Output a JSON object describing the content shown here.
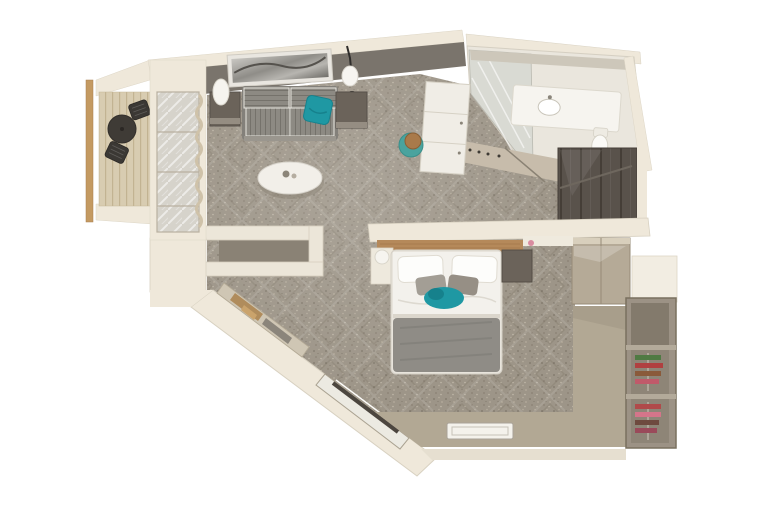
{
  "scene": {
    "title": "3D top-down floor plan render of a hotel suite with balcony",
    "style": "photorealistic axonometric render, no visible text",
    "background": "#ffffff"
  },
  "colors": {
    "wall_top": "#efe8da",
    "wall_face": "#7a746c",
    "wall_edge": "#d8d1c1",
    "carpet_base": "#9d9588",
    "deck_wood": "#d8ccb1",
    "railing": "#c49a62",
    "glass": "#d6d3cb",
    "sofa_fabric": "#8d8a83",
    "accent_teal": "#1f98a3",
    "side_table": "#6b635a",
    "coffee_table": "#f2efe9",
    "cabinet_white": "#f0ede6",
    "stool_teal": "#4aa39e",
    "stool_wood": "#a97a4a",
    "bed_duvet": "#f3f1ec",
    "bed_blanket": "#8f8c86",
    "pillow_gray": "#a39e95",
    "headboard_wood": "#b5895a",
    "nightstand": "#6b635a",
    "bathroom_floor": "#eae6dd",
    "fixture_white": "#f6f4ef",
    "closet_dark": "#59524b",
    "wardrobe_taupe": "#b5aa97",
    "shelf_unit": "#9c9285",
    "entry_floor": "#b2a894",
    "doormat": "#f4f2ec",
    "console_wood": "#b08c5c",
    "art_frame": "#e9e6e0",
    "outdoor_furniture": "#3f3b36",
    "wedge_taupe": "#c7bcab"
  },
  "rooms": [
    {
      "id": "balcony",
      "label": "Balcony",
      "furniture": [
        "wood deck",
        "railing",
        "round bistro table",
        "two wire chairs"
      ]
    },
    {
      "id": "living-area",
      "label": "Living area",
      "furniture": [
        "gray tweed sofa",
        "teal throw pillow",
        "oval white coffee table",
        "two dark side tables",
        "white table lamp",
        "black floor lamp",
        "abstract wall art",
        "white minibar cabinet",
        "teal stool with wood top",
        "sliding glass door to balcony"
      ]
    },
    {
      "id": "bedroom",
      "label": "Bedroom",
      "furniture": [
        "double bed with white duvet",
        "two white pillows",
        "gray accent pillows",
        "teal throw",
        "gray foot blanket",
        "wood headboard panel",
        "dark nightstand",
        "round white bedside lamp"
      ]
    },
    {
      "id": "bathroom",
      "label": "Bathroom",
      "furniture": [
        "glass shower",
        "vanity counter with sink",
        "mirror shelf",
        "toilet"
      ]
    },
    {
      "id": "dressing-area",
      "label": "Dressing area",
      "furniture": [
        "dark open closet",
        "sliding-door wardrobe",
        "open shoe shelf with shoes"
      ]
    },
    {
      "id": "entry",
      "label": "Entry hall",
      "furniture": [
        "doormat",
        "diagonal console shelf",
        "recessed bench slot"
      ]
    }
  ]
}
